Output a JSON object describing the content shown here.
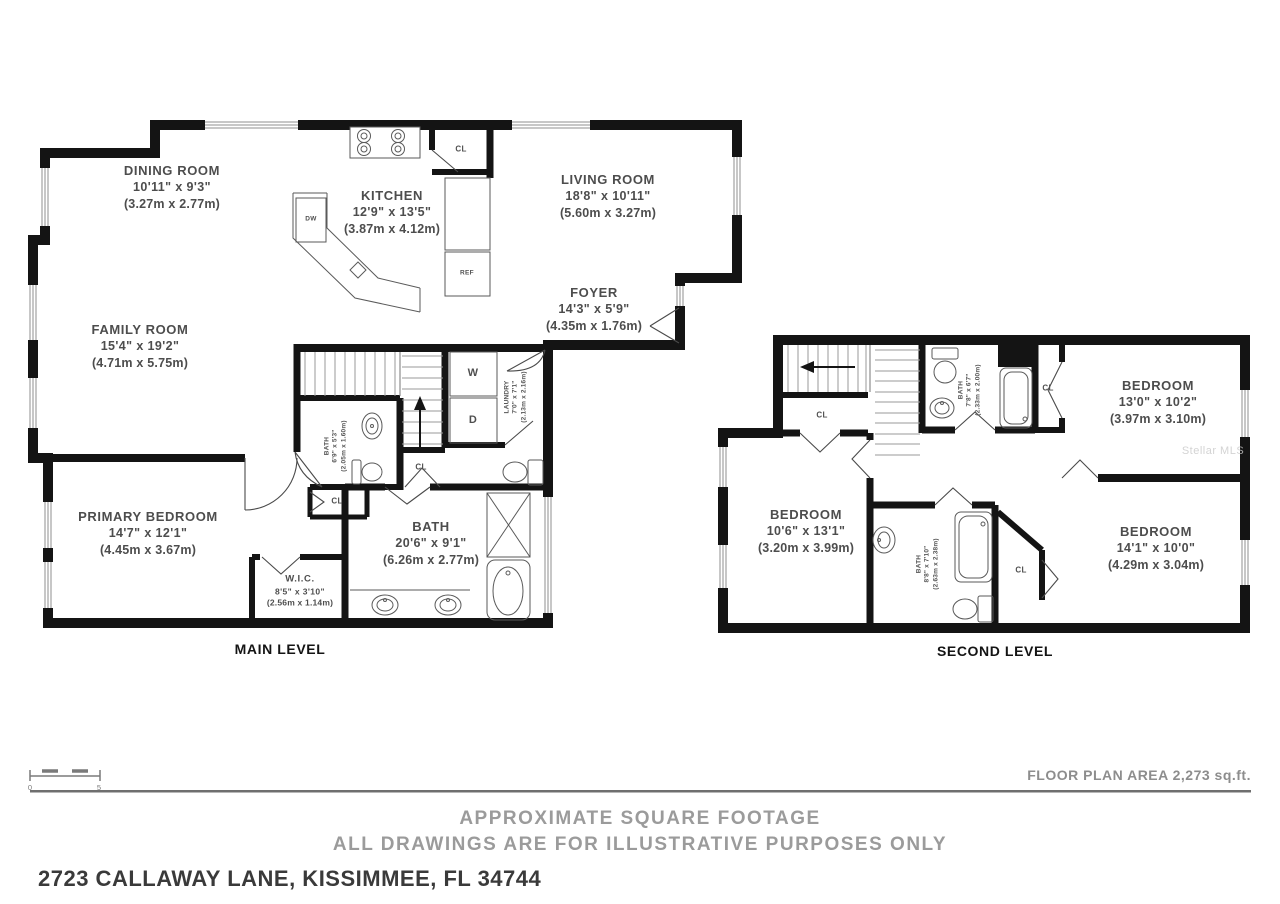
{
  "address": "2723 CALLAWAY LANE, KISSIMMEE, FL 34744",
  "footer": {
    "area_label": "FLOOR PLAN AREA 2,273 sq.ft.",
    "disclaimer_line1": "APPROXIMATE SQUARE FOOTAGE",
    "disclaimer_line2": "ALL DRAWINGS ARE FOR ILLUSTRATIVE PURPOSES ONLY"
  },
  "watermark": "Stellar MLS",
  "scale_bar": {
    "start_label": "0",
    "end_label": "5"
  },
  "abbr": {
    "closet": "CL",
    "washer": "W",
    "dryer": "D",
    "dishwasher": "DW",
    "refrigerator": "REF"
  },
  "colors": {
    "wall": "#141414",
    "label": "#4d4d4d",
    "muted": "#9b9b9b"
  },
  "levels": [
    {
      "name": "MAIN LEVEL",
      "rooms": [
        {
          "name": "DINING ROOM",
          "dims_ft": "10'11\" x 9'3\"",
          "dims_m": "(3.27m x 2.77m)"
        },
        {
          "name": "KITCHEN",
          "dims_ft": "12'9\" x 13'5\"",
          "dims_m": "(3.87m x 4.12m)"
        },
        {
          "name": "LIVING ROOM",
          "dims_ft": "18'8\" x 10'11\"",
          "dims_m": "(5.60m x 3.27m)"
        },
        {
          "name": "FOYER",
          "dims_ft": "14'3\" x 5'9\"",
          "dims_m": "(4.35m x 1.76m)"
        },
        {
          "name": "FAMILY ROOM",
          "dims_ft": "15'4\" x 19'2\"",
          "dims_m": "(4.71m x 5.75m)"
        },
        {
          "name": "PRIMARY BEDROOM",
          "dims_ft": "14'7\" x 12'1\"",
          "dims_m": "(4.45m x 3.67m)"
        },
        {
          "name": "BATH",
          "dims_ft": "20'6\" x 9'1\"",
          "dims_m": "(6.26m x 2.77m)"
        },
        {
          "name": "W.I.C.",
          "dims_ft": "8'5\" x 3'10\"",
          "dims_m": "(2.56m x 1.14m)"
        },
        {
          "name": "BATH",
          "dims_ft": "6'9\" x 5'3\"",
          "dims_m": "(2.05m x 1.60m)"
        },
        {
          "name": "LAUNDRY",
          "dims_ft": "7'0\" x 7'1\"",
          "dims_m": "(2.13m x 2.16m)"
        }
      ]
    },
    {
      "name": "SECOND LEVEL",
      "rooms": [
        {
          "name": "BEDROOM",
          "dims_ft": "13'0\" x 10'2\"",
          "dims_m": "(3.97m x 3.10m)"
        },
        {
          "name": "BEDROOM",
          "dims_ft": "10'6\" x 13'1\"",
          "dims_m": "(3.20m x 3.99m)"
        },
        {
          "name": "BEDROOM",
          "dims_ft": "14'1\" x 10'0\"",
          "dims_m": "(4.29m x 3.04m)"
        },
        {
          "name": "BATH",
          "dims_ft": "7'8\" x 6'7\"",
          "dims_m": "(2.33m x 2.00m)"
        },
        {
          "name": "BATH",
          "dims_ft": "8'8\" x 7'10\"",
          "dims_m": "(2.63m x 2.38m)"
        }
      ]
    }
  ]
}
